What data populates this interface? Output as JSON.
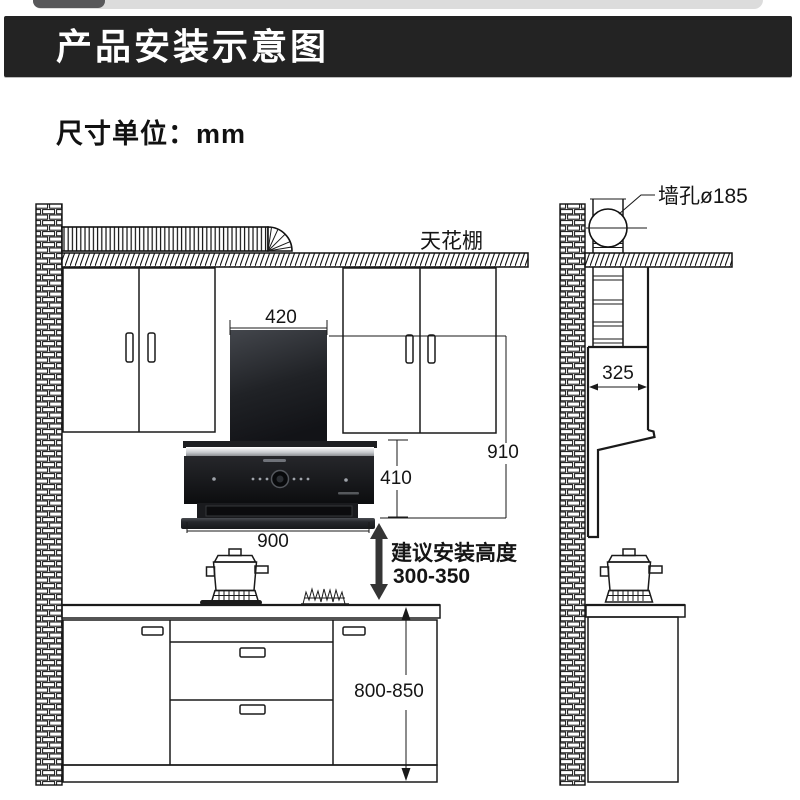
{
  "banner": {
    "title": "产品安装示意图",
    "bg": "#232323",
    "text_color": "#ffffff"
  },
  "unit_note": "尺寸单位：mm",
  "labels": {
    "ceiling": "天花棚",
    "wall_hole": "墙孔ø185",
    "install_height_line1": "建议安装高度",
    "install_height_line2": "300-350"
  },
  "dimensions": {
    "chimney_top_width": "420",
    "total_height": "910",
    "body_height": "410",
    "body_width": "900",
    "side_depth": "325",
    "counter_height": "800-850"
  },
  "colors": {
    "banner_bg": "#232323",
    "line": "#1a1a1a",
    "hood_dark": "#141518"
  }
}
